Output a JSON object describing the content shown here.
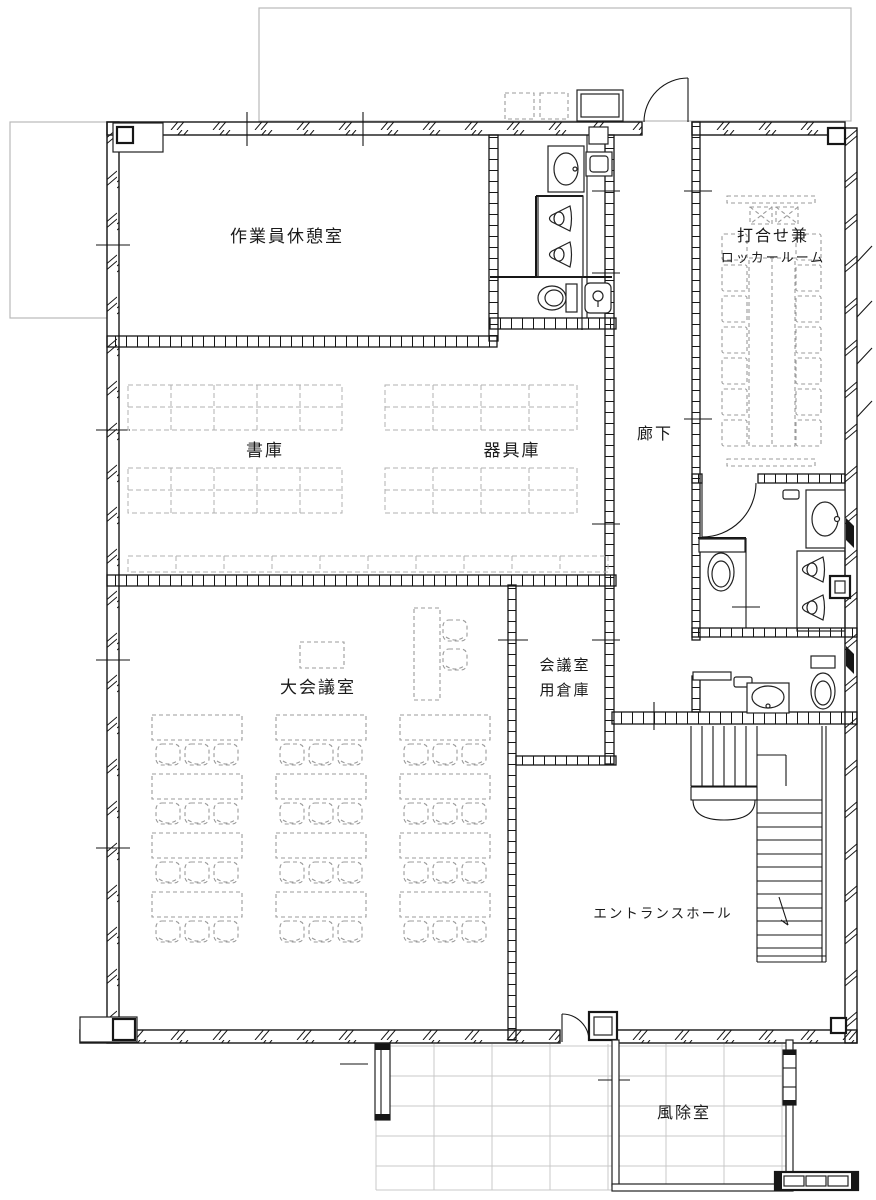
{
  "drawing": {
    "type": "architectural-floor-plan",
    "rooms": {
      "worker_lounge": "作業員休憩室",
      "book_storage": "書庫",
      "equipment_storage": "器具庫",
      "corridor": "廊下",
      "meeting_locker_line1": "打合せ兼",
      "meeting_locker_line2": "ロッカールーム",
      "large_conference": "大会議室",
      "conference_storage_line1": "会議室",
      "conference_storage_line2": "用倉庫",
      "entrance_hall": "エントランスホール",
      "windbreak_room": "風除室"
    },
    "colors": {
      "line": "#161616",
      "furniture_dash": "#9b9b9b",
      "shelf_dash": "#b0b0b0",
      "tile_grid": "#c9c9c9",
      "exterior_outline": "#b9b9b9",
      "background": "#ffffff"
    }
  }
}
